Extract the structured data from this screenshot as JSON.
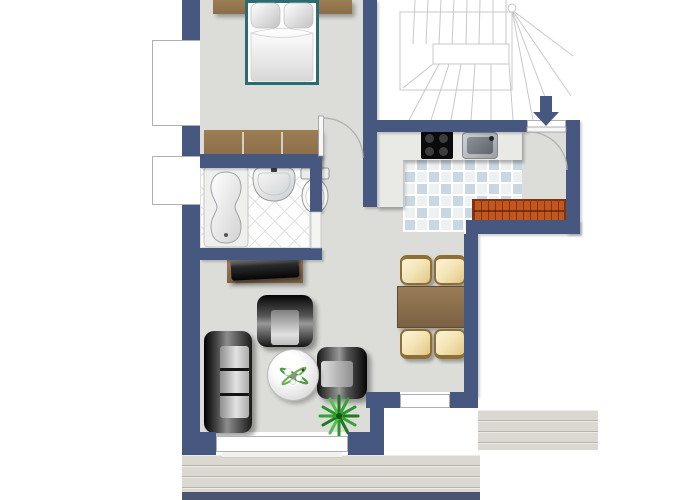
{
  "plan_title": "apartment-floor-plan",
  "colors": {
    "wall": "#475880",
    "floor": "#dcdcd9",
    "bath_floor": "#fdfdfd",
    "tile_blue": "#c9d7e3",
    "tile_light": "#eef1f2",
    "grout": "#ffffff",
    "counter": "#e9e9e6",
    "wood": "#8a6d49",
    "wood_light": "#9c7e55",
    "radiator": "#c2561f",
    "radiator_dark": "#7e3410",
    "chair_fill": "#f2e2b0",
    "chair_border": "#8d6f35",
    "deck": "#dbd8d1",
    "deck_line": "#b7b4ac",
    "bed_frame": "#2a6b74",
    "plant_green": "#2e8f2e",
    "arc": "#b3b3b3",
    "window_frame": "#b0b0b0",
    "stair_line": "#c8c8c8",
    "base_strip": "#4a5572"
  },
  "rooms": [
    {
      "name": "bedroom"
    },
    {
      "name": "bathroom"
    },
    {
      "name": "hallway"
    },
    {
      "name": "kitchen"
    },
    {
      "name": "entry"
    },
    {
      "name": "living-room"
    },
    {
      "name": "dining-area"
    },
    {
      "name": "stairwell"
    },
    {
      "name": "terrace-deck"
    }
  ],
  "furniture": {
    "bedroom": [
      "double-bed",
      "headboard",
      "dresser"
    ],
    "bathroom": [
      "bathtub",
      "washbasin",
      "toilet"
    ],
    "kitchen": [
      "countertop",
      "cooktop",
      "kitchen-sink",
      "radiator"
    ],
    "living_room": [
      "tv-sideboard",
      "tv",
      "sofa",
      "armchair",
      "armchair",
      "round-coffee-table",
      "potted-plant"
    ],
    "dining_area": [
      "dining-table",
      "chair",
      "chair",
      "chair",
      "chair"
    ]
  },
  "entrance": {
    "indicator": "down-arrow"
  }
}
